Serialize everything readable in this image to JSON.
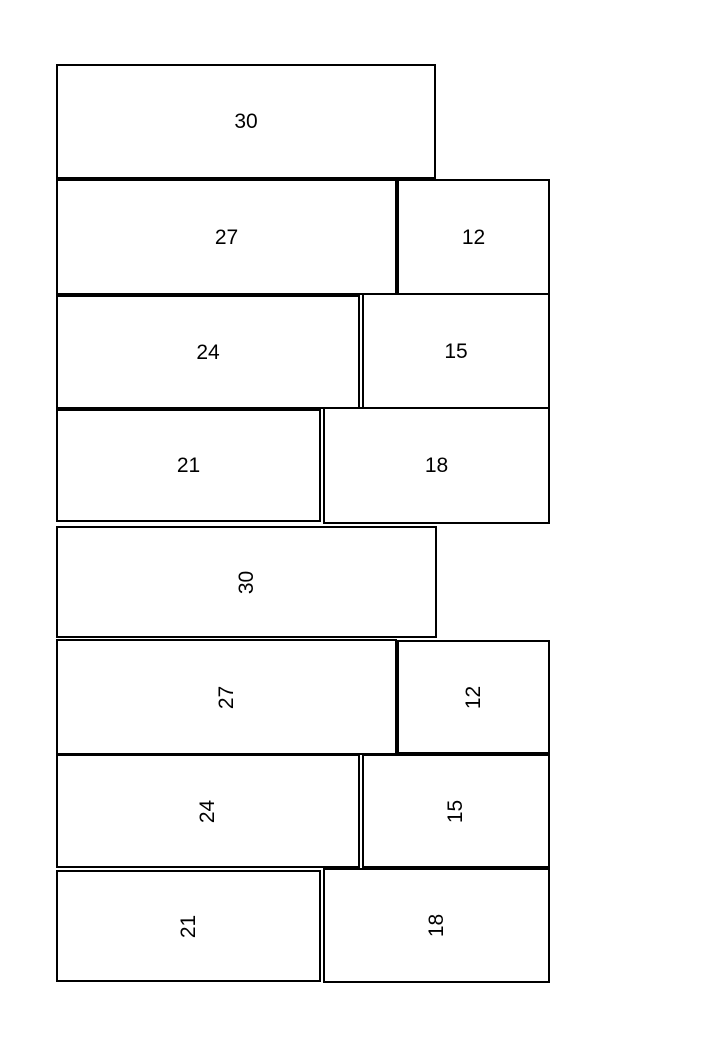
{
  "colors": {
    "page_background": "#ffffff",
    "box_fill": "#ffffff",
    "box_border": "#000000",
    "label_text": "#000000"
  },
  "sections": [
    {
      "name": "top-bars",
      "label_orientation": "horizontal",
      "rows": [
        {
          "boxes": [
            {
              "value": "30"
            }
          ]
        },
        {
          "boxes": [
            {
              "value": "27"
            },
            {
              "value": "12"
            }
          ]
        },
        {
          "boxes": [
            {
              "value": "24"
            },
            {
              "value": "15"
            }
          ]
        },
        {
          "boxes": [
            {
              "value": "21"
            },
            {
              "value": "18"
            }
          ]
        }
      ]
    },
    {
      "name": "bottom-bars",
      "label_orientation": "rotated-90-ccw",
      "rows": [
        {
          "boxes": [
            {
              "value": "30"
            }
          ]
        },
        {
          "boxes": [
            {
              "value": "27"
            },
            {
              "value": "12"
            }
          ]
        },
        {
          "boxes": [
            {
              "value": "24"
            },
            {
              "value": "15"
            }
          ]
        },
        {
          "boxes": [
            {
              "value": "21"
            },
            {
              "value": "18"
            }
          ]
        }
      ]
    }
  ]
}
